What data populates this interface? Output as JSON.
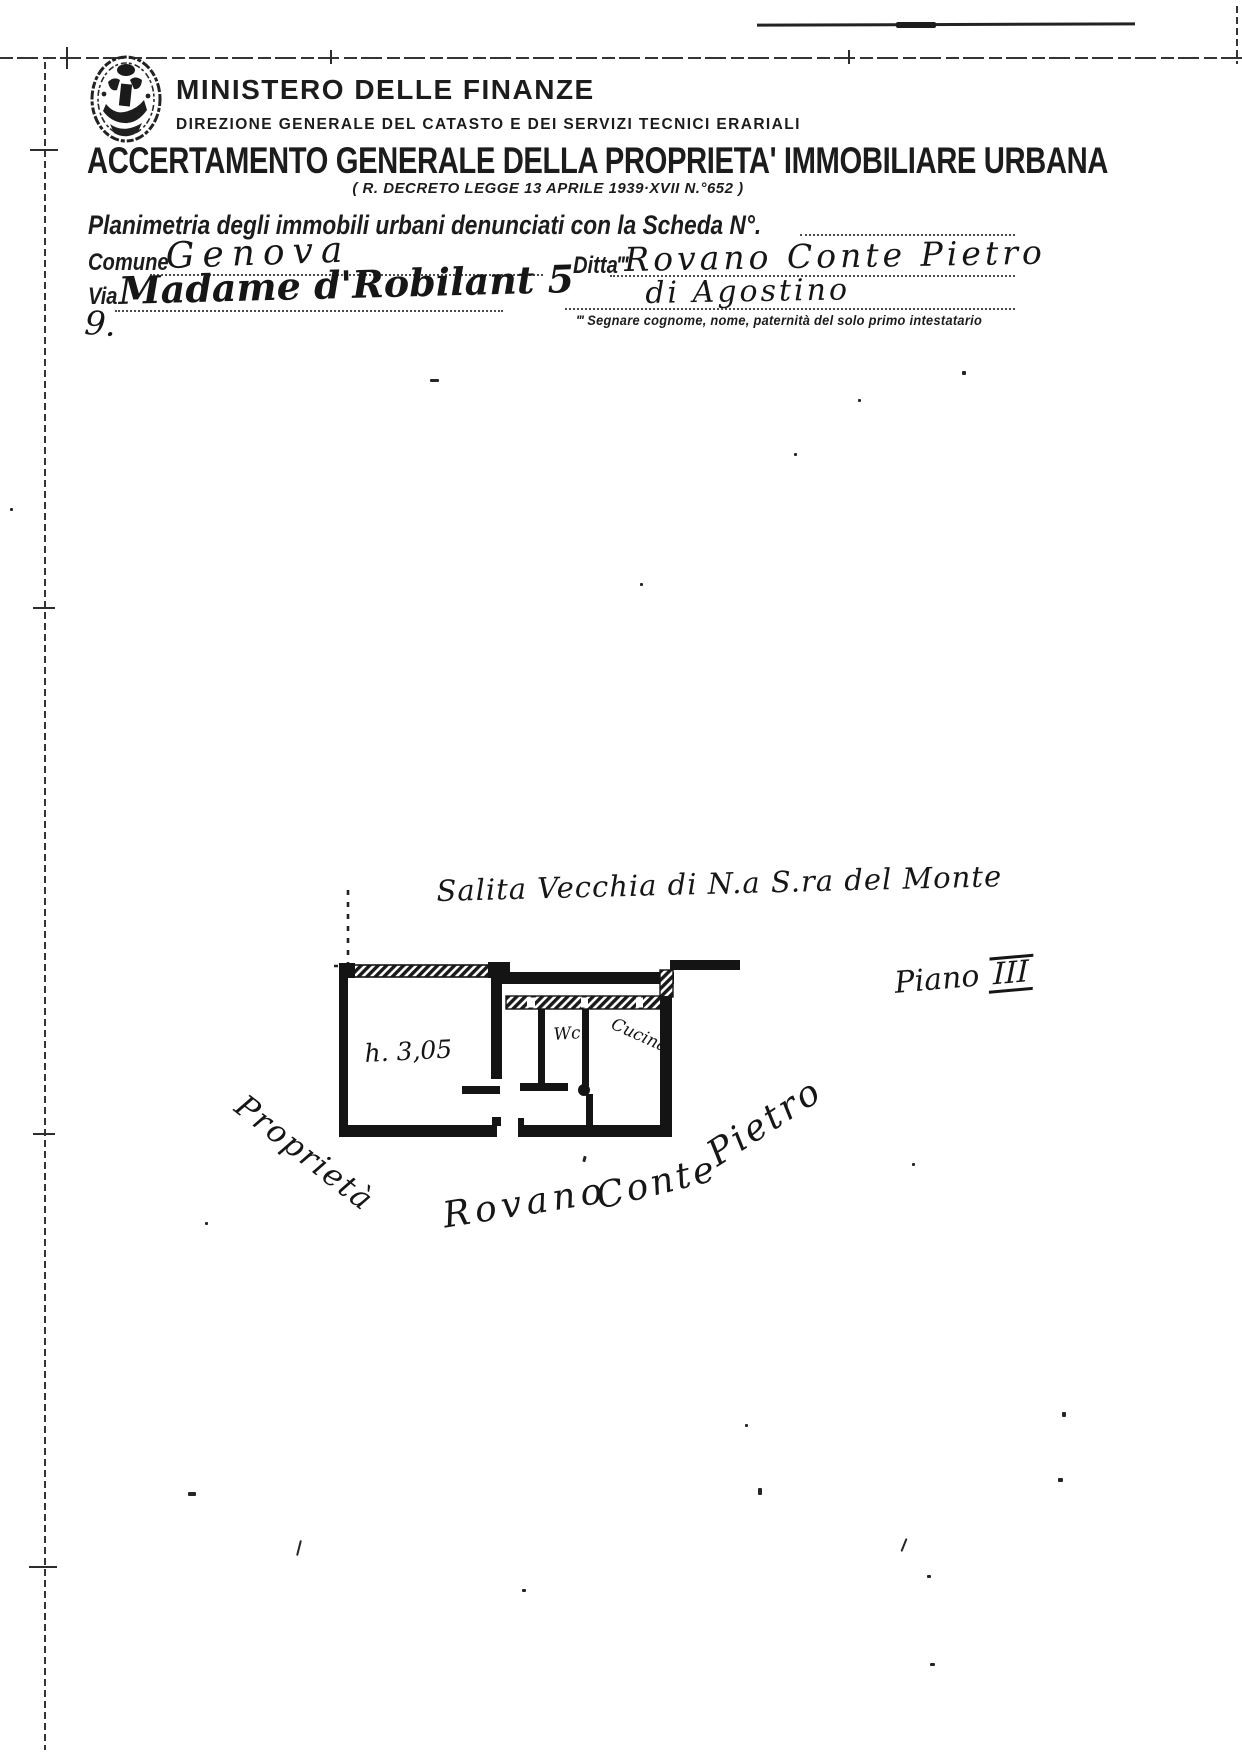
{
  "document": {
    "ministry": "MINISTERO DELLE FINANZE",
    "direction": "DIREZIONE GENERALE DEL CATASTO E DEI SERVIZI TECNICI ERARIALI",
    "title": "ACCERTAMENTO GENERALE DELLA PROPRIETA' IMMOBILIARE URBANA",
    "decree": "( R. DECRETO LEGGE 13 APRILE 1939·XVII N.°652 )"
  },
  "form": {
    "planimetria_label": "Planimetria degli immobili urbani denunciati con la Scheda N°.",
    "comune_label": "Comune",
    "comune_value": "Genova",
    "ditta_label": "Ditta‴",
    "ditta_value": "Rovano Conte Pietro",
    "ditta_paternita": "di Agostino",
    "via_label": "Via",
    "via_value": "Madame d'Robilant 5",
    "footnote": "‴ Segnare cognome, nome, paternità del solo primo intestatario",
    "stray_mark": "9."
  },
  "plan": {
    "street": "Salita Vecchia di N.a S.ra del Monte",
    "floor_label": "Piano",
    "floor_value": "III",
    "room_height": "h. 3,05",
    "wc": "Wc",
    "kitchen": "Cucina",
    "property_label": "Proprietà",
    "owner_first": "Rovano",
    "owner_middle": "Conte",
    "owner_last": "Pietro"
  },
  "colors": {
    "ink": "#1c1c1c",
    "paper": "#ffffff"
  }
}
